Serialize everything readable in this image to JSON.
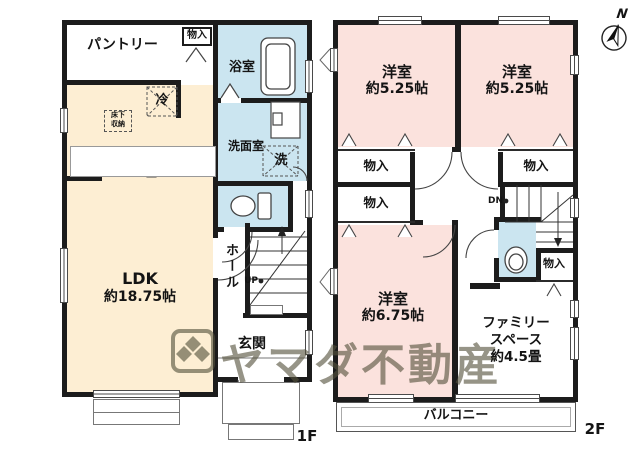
{
  "compass": {
    "north": "N"
  },
  "watermark": {
    "text": "ヤマダ不動産"
  },
  "colors": {
    "ldk_cream": "#fdeed3",
    "bedroom_pink": "#fbe2dd",
    "wet_area_blue": "#cbe5f0",
    "wall_black": "#1c1c1c",
    "watermark_olive": "rgba(85,82,62,0.62)"
  },
  "floor1": {
    "label": "1F",
    "pantry": "パントリー",
    "closet": "物入",
    "bath": "浴室",
    "washroom": "洗面室",
    "washer": "洗",
    "fridge": "冷",
    "underfloor_top": "床下",
    "underfloor_bottom": "収納",
    "ldk_name": "LDK",
    "ldk_size": "約18.75帖",
    "hall": "ホール",
    "up": "UP",
    "entrance": "玄関"
  },
  "floor2": {
    "label": "2F",
    "bedroom1_name": "洋室",
    "bedroom1_size": "約5.25帖",
    "bedroom2_name": "洋室",
    "bedroom2_size": "約5.25帖",
    "bedroom3_name": "洋室",
    "bedroom3_size": "約6.75帖",
    "closet1": "物入",
    "closet2": "物入",
    "closet3": "物入",
    "closet4": "物入",
    "family_line1": "ファミリー",
    "family_line2": "スペース",
    "family_line3": "約4.5畳",
    "dn": "DN",
    "balcony": "バルコニー"
  }
}
